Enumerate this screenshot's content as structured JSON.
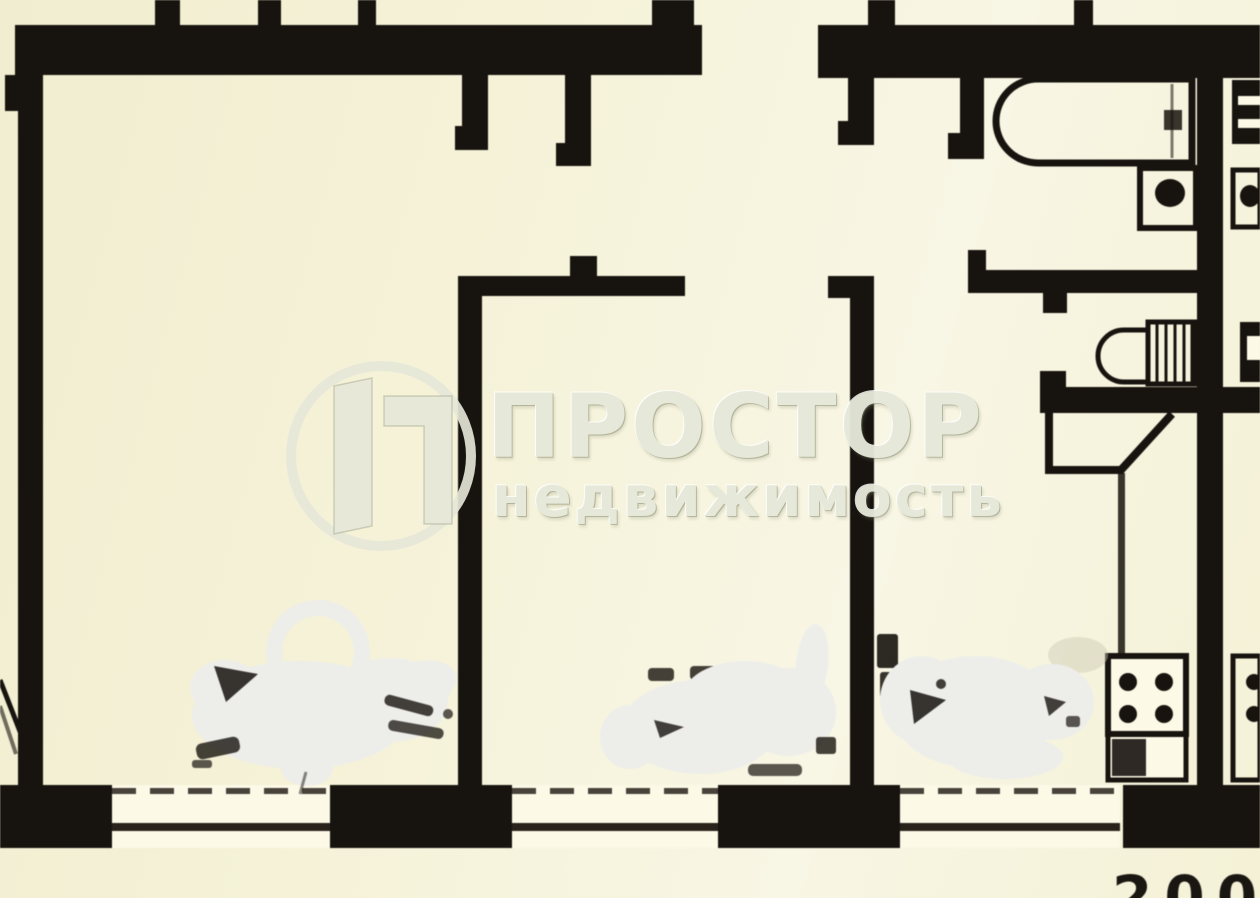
{
  "watermark": {
    "brand": "ПРОСТОР",
    "subtitle": "недвижимость",
    "logo": "circle-with-3d-letter-P-icon"
  },
  "annotations": {
    "partial_dimension": "200"
  },
  "colors": {
    "ink": "#1a1612",
    "paper": "#f5f2d8",
    "paper_light": "#f8f6e3",
    "eraser": "#eaeae7",
    "watermark": "#e6e8d9",
    "window_line": "#2b251e"
  },
  "plan_elements": {
    "rooms": [
      "living-room",
      "middle-room",
      "kitchen",
      "hallway",
      "bathroom",
      "wc"
    ],
    "fixtures": [
      "bathtub",
      "washbasin",
      "toilet",
      "stove",
      "kitchen-vent-shaft",
      "counter"
    ],
    "windows": [
      "living-room-window",
      "middle-room-window",
      "kitchen-window"
    ],
    "erased_labels": [
      "living-room-area-erased",
      "middle-room-area-erased",
      "kitchen-area-erased"
    ]
  }
}
